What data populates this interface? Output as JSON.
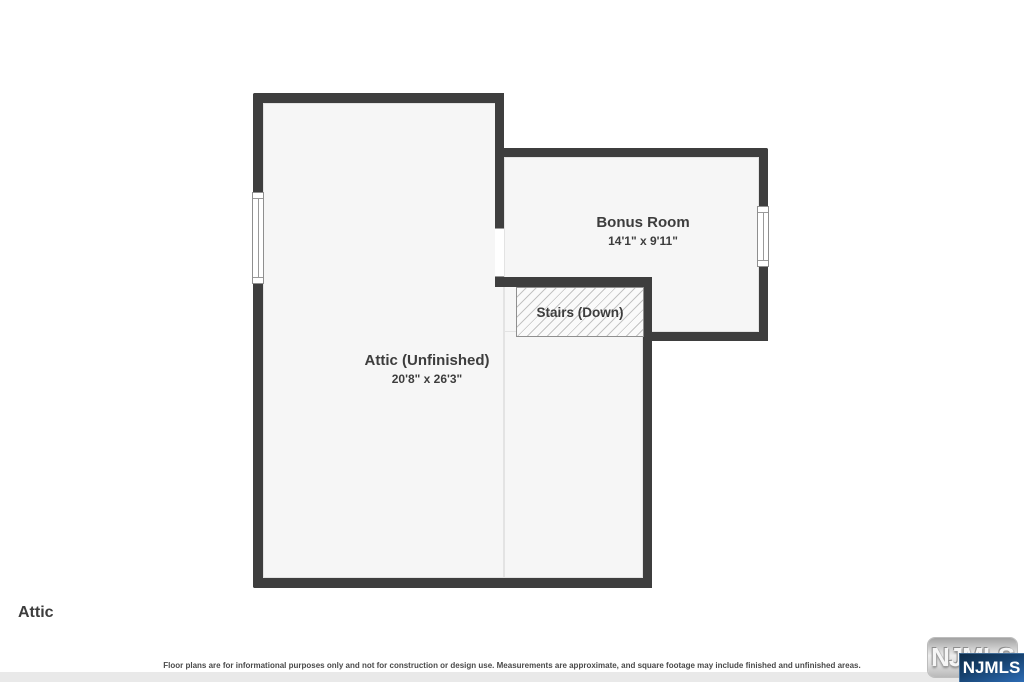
{
  "floorplan": {
    "floor_label": "Attic",
    "rooms": [
      {
        "name": "Attic (Unfinished)",
        "dimensions": "20'8\" x 26'3\""
      },
      {
        "name": "Bonus Room",
        "dimensions": "14'1\" x 9'11\""
      }
    ],
    "stairs_label": "Stairs (Down)",
    "disclaimer": "Floor plans are for informational purposes only and not for construction or design use. Measurements are approximate, and square footage may include finished and unfinished areas.",
    "logo": {
      "watermark_text": "NJMLS",
      "badge_text": "NJMLS"
    },
    "colors": {
      "wall": "#3e3e3e",
      "room_fill": "#f6f6f6",
      "hatch_line": "#c3c3c3",
      "label_text": "#3d3d3d",
      "footer_strip": "#e9e9e9",
      "logo_blue_dark": "#0d2b47",
      "logo_blue_light": "#2d6cb5"
    }
  }
}
